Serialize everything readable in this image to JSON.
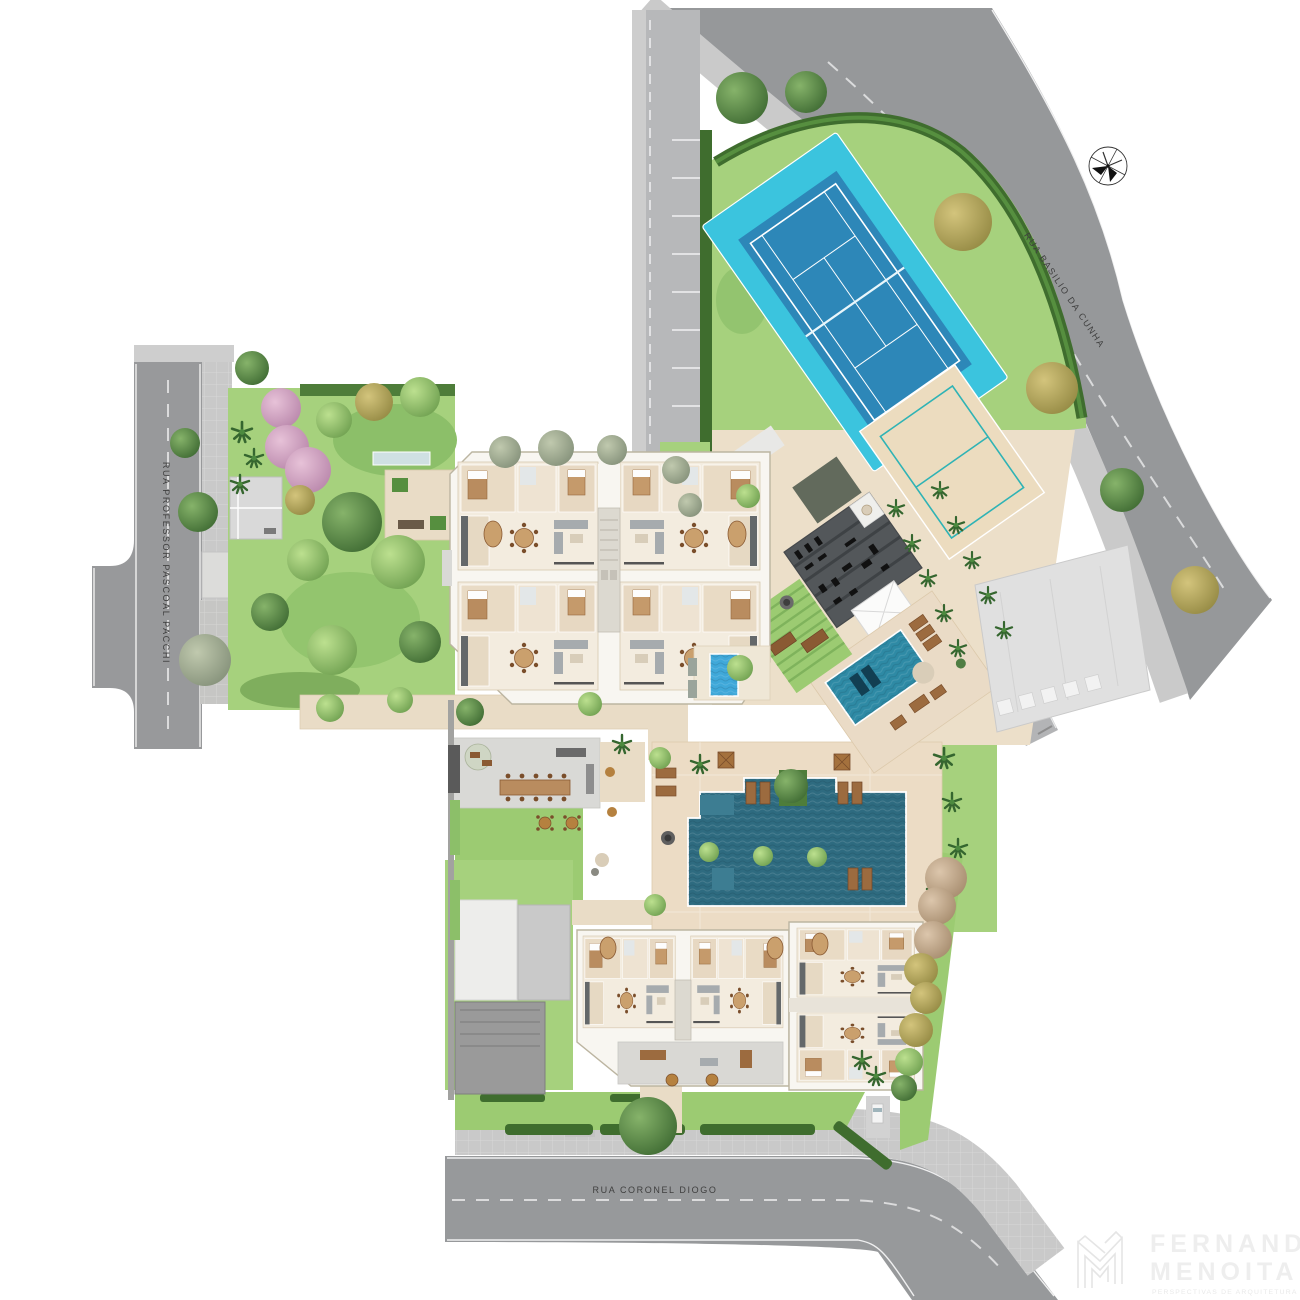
{
  "streets": {
    "left": "RUA PROFESSOR PASCOAL PACCHI",
    "top_right": "RUA BASILIO DA CUNHA",
    "bottom": "RUA CORONEL DIOGO"
  },
  "logo": {
    "line1": "FERNANDO",
    "line2": "MENOITA",
    "tagline": "PERSPECTIVAS DE ARQUITETURA"
  },
  "icons": {
    "compass": "compass-rose-north-icon",
    "monogram": "fm-monogram-icon"
  },
  "palette": {
    "asphalt": "#96989A",
    "sidewalk": "#CBCBCB",
    "lawn": "#A6D17D",
    "lawn_dark": "#8CBF69",
    "hedge": "#3F6D2E",
    "path_beige": "#E9DCC6",
    "deck_beige": "#ECDCC5",
    "tennis_surround": "#3BC4DE",
    "tennis_court": "#2D87B8",
    "sand_court": "#ECDCBF",
    "sand_lines": "#2FB3B5",
    "lap_pool": "#2E6B80",
    "leisure_pool": "#2E8AA5",
    "spa_pool": "#3FA8D9",
    "building": "#F8F6F1",
    "building_edge": "#BCB5A1",
    "gym_roof": "#53575A",
    "neighbor_building": "#E0E0E0",
    "wood": "#9C6B3F",
    "label_text": "#3F3F3F",
    "logo_gray": "#EEEEEE"
  }
}
